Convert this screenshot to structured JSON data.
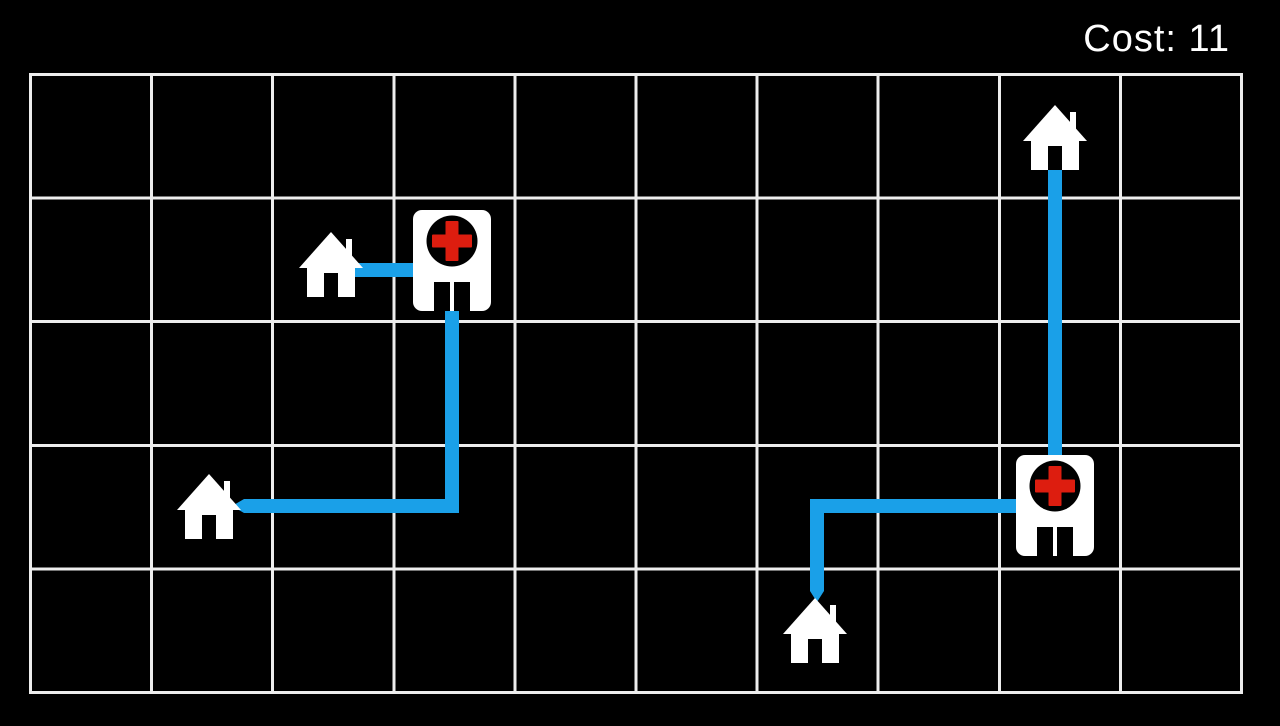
{
  "hud": {
    "cost_text": "Cost: 11",
    "cost_label": "Cost:",
    "cost_value": 11
  },
  "board": {
    "rows": 5,
    "cols": 10,
    "background_color": "#000000",
    "grid_line_color": "#ededed",
    "path_color": "#1aa0e8",
    "building_color": "#ffffff",
    "cross_color": "#dd1d0f",
    "houses": [
      {
        "id": "house-1",
        "col": 2,
        "row": 1
      },
      {
        "id": "house-2",
        "col": 1,
        "row": 3
      },
      {
        "id": "house-3",
        "col": 6,
        "row": 4
      },
      {
        "id": "house-4",
        "col": 8,
        "row": 0
      }
    ],
    "hospitals": [
      {
        "id": "hospital-1",
        "col": 3,
        "row": 1
      },
      {
        "id": "hospital-2",
        "col": 8,
        "row": 3
      }
    ],
    "routes": [
      {
        "from": "house-1",
        "to": "hospital-1",
        "cost": 1
      },
      {
        "from": "house-2",
        "to": "hospital-1",
        "cost": 4
      },
      {
        "from": "house-3",
        "to": "hospital-2",
        "cost": 3
      },
      {
        "from": "house-4",
        "to": "hospital-2",
        "cost": 3
      }
    ]
  }
}
